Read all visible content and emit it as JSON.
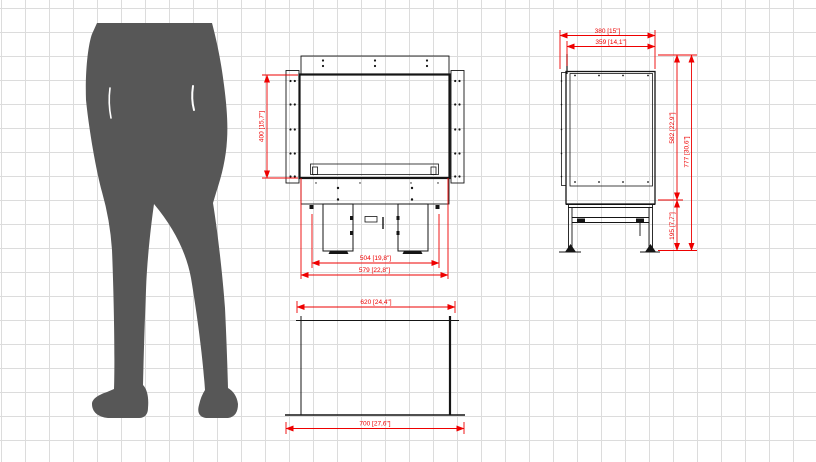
{
  "colors": {
    "dimension_red": "#ee0000",
    "drawing_black": "#151515",
    "silhouette_gray": "#575757",
    "grid_gray": "#dcdcdc",
    "background": "#ffffff"
  },
  "views": {
    "front": {
      "dims": {
        "height": "400 [15,7\"]",
        "inner_width": "504 [19,8\"]",
        "overall_width": "579 [22,8\"]"
      }
    },
    "side": {
      "dims": {
        "depth": "380 [15\"]",
        "inner_depth": "359 [14,1\"]",
        "body_height": "582 [22,9\"]",
        "total_height": "777 [30,6\"]",
        "base_height": "195 [7,7\"]"
      }
    },
    "plan": {
      "dims": {
        "top_width": "620 [24,4\"]",
        "base_width": "700 [27,6\"]"
      }
    }
  }
}
